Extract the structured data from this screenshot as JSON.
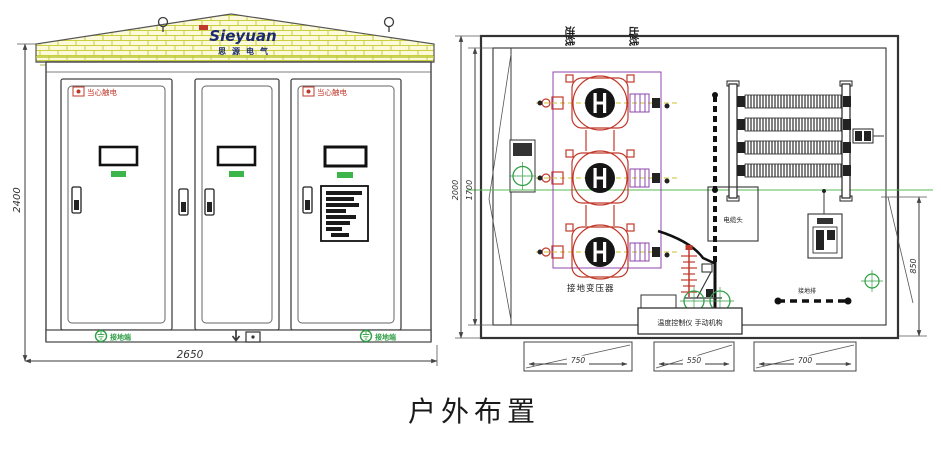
{
  "title": "户外布置",
  "front_view": {
    "logo": "Sieyuan",
    "logo_sub": "思源电气",
    "warning_door1": "当心触电",
    "warning_door3": "当心触电",
    "ground_left": "接地端",
    "ground_right": "接地端",
    "dim_height": "2400",
    "dim_width": "2650"
  },
  "plan_view": {
    "inlet_label": "进线",
    "outlet_label": "出线",
    "transformer_label": "接地变压器",
    "cable_head_label": "电缆头",
    "busbar_label": "接地排",
    "control_label": "温度控制仪 手动机构",
    "dim_left_outer": "2000",
    "dim_left_inner": "1700",
    "dim_right": "850",
    "dim_bottom_1": "750",
    "dim_bottom_2": "550",
    "dim_bottom_3": "700"
  },
  "colors": {
    "line": "#3a3a3a",
    "red": "#c0392b",
    "green": "#2f9e44",
    "purple": "#8e44ad",
    "brick_line": "#c9cf3e",
    "brick_fill": "#fcfad9",
    "navy": "#1b2a72"
  }
}
